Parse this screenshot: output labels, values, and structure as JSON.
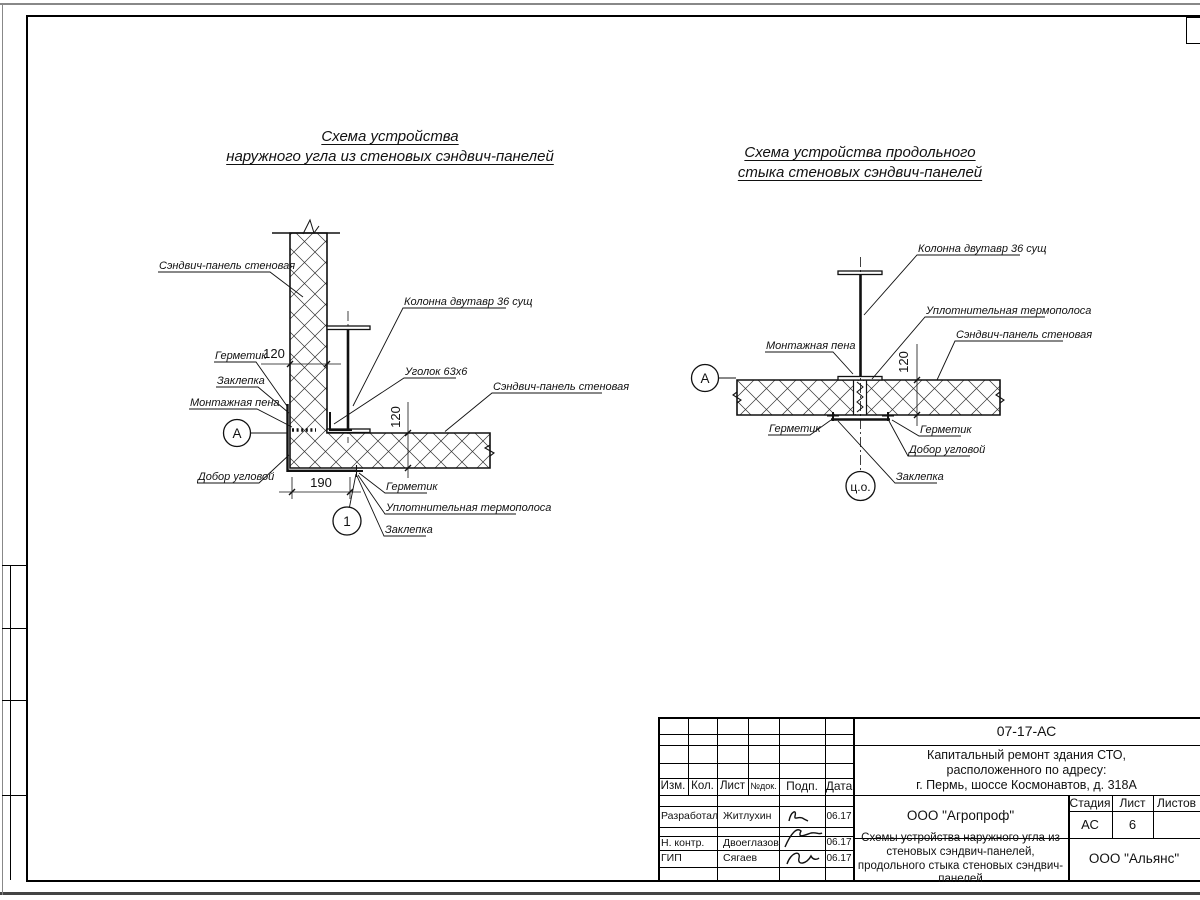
{
  "titles": {
    "left_line1": "Схема устройства",
    "left_line2": "наружного угла из стеновых сэндвич-панелей",
    "right_line1": "Схема устройства продольного",
    "right_line2": "стыка стеновых сэндвич-панелей"
  },
  "left_diagram": {
    "labels": {
      "panel_wall_v": "Сэндвич-панель стеновая",
      "column": "Колонна двутавр 36 сущ",
      "angle": "Уголок 63х6",
      "panel_wall_h": "Сэндвич-панель стеновая",
      "sealant_top": "Герметик",
      "rivet_top": "Заклепка",
      "foam": "Монтажная пена",
      "corner_trim": "Добор угловой",
      "sealant_bottom": "Герметик",
      "thermal_strip": "Уплотнительная термополоса",
      "rivet_bottom": "Заклепка"
    },
    "dims": {
      "wall_thickness": "120",
      "panel_thickness": "120",
      "corner_offset": "190"
    },
    "markers": {
      "axis": "А",
      "node": "1"
    }
  },
  "right_diagram": {
    "labels": {
      "column": "Колонна двутавр 36 сущ",
      "thermal_strip": "Уплотнительная термополоса",
      "panel_wall": "Сэндвич-панель стеновая",
      "foam": "Монтажная пена",
      "sealant_left": "Герметик",
      "sealant_right": "Герметик",
      "corner_trim": "Добор угловой",
      "rivet": "Заклепка"
    },
    "dims": {
      "panel_thickness": "120"
    },
    "markers": {
      "axis": "А",
      "center": "ц.о."
    }
  },
  "titleblock": {
    "doc_number": "07-17-АС",
    "project_line1": "Капитальный ремонт здания СТО,",
    "project_line2": "расположенного по адресу:",
    "project_line3": "г. Пермь, шоссе Космонавтов, д. 318А",
    "headers": {
      "izm": "Изм.",
      "kol": "Кол.",
      "list": "Лист",
      "ndok": "№док.",
      "podp": "Подп.",
      "data": "Дата"
    },
    "rows": [
      {
        "role": "Разработал",
        "name": "Житлухин",
        "date": "06.17"
      },
      {
        "role": "Н. контр.",
        "name": "Двоеглазов",
        "date": "06.17"
      },
      {
        "role": "ГИП",
        "name": "Сягаев",
        "date": "06.17"
      }
    ],
    "org_design": "ООО \"Агропроф\"",
    "org_customer": "ООО \"Альянс\"",
    "doc_title": "Схемы устройства наружного угла из стеновых сэндвич-панелей, продольного стыка стеновых сэндвич-панелей",
    "stage_header": "Стадия",
    "sheet_header": "Лист",
    "sheets_header": "Листов",
    "stage": "АС",
    "sheet": "6",
    "sheets": ""
  }
}
